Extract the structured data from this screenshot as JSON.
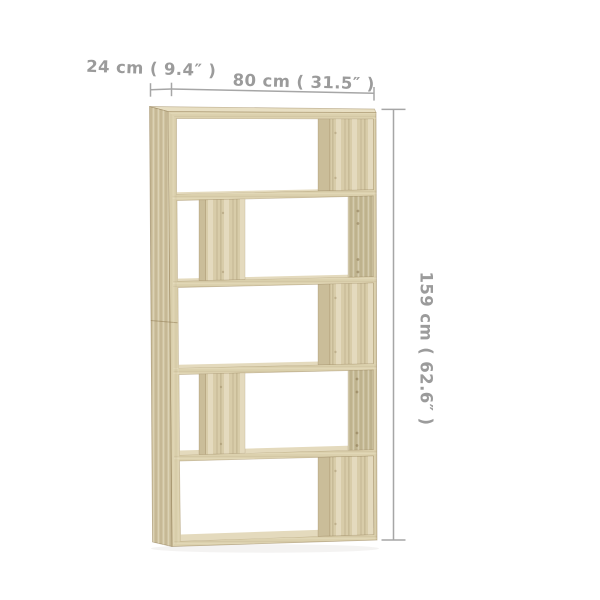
{
  "figure": {
    "type": "furniture-dimension-diagram",
    "item": "5-tier open bookshelf / room divider, light oak wood",
    "compartments": 5,
    "divider_layout": [
      "right",
      "left-center",
      "right",
      "left-center",
      "right"
    ],
    "screw_holes_visible": true
  },
  "dimensions": {
    "depth": {
      "label": "24 cm ( 9.4″ )"
    },
    "width": {
      "label": "80 cm ( 31.5″ )"
    },
    "height": {
      "label": "159 cm ( 62.6″ )"
    }
  },
  "colors": {
    "background": "#ffffff",
    "wood_front": "#dcd1ae",
    "wood_top": "#e8dfc3",
    "wood_side": "#cfc3a0",
    "wood_wall": "#c6bb97",
    "wood_divider": "#d8cca9",
    "wood_divider_edge": "#cabd99",
    "wood_floor": "#e4dabd",
    "edge_line": "#b3a47b",
    "dim_line": "#a6a6a6",
    "dim_text": "#9b9b9b"
  }
}
